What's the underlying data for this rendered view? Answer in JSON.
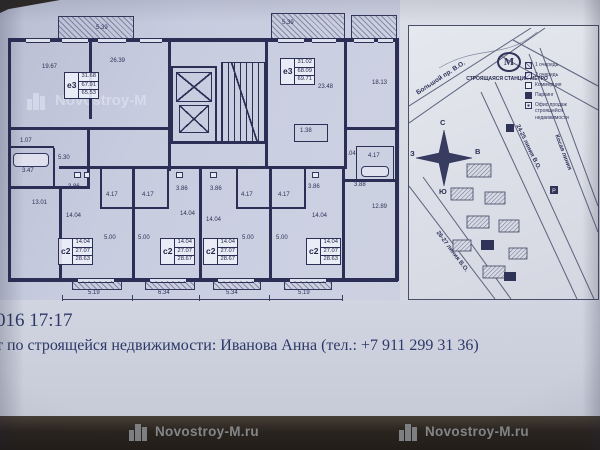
{
  "branding": {
    "watermark_full": "Novostroy-M.ru",
    "watermark_short": "Novostroy-M"
  },
  "footer": {
    "timestamp": "016 17:17",
    "contact_line": "т по строящейся недвижимости: Иванова Анна (тел.: +7 911 299 31 36)"
  },
  "floorplan": {
    "apartments": {
      "left": {
        "code": "е3",
        "areas": [
          "31.68",
          "67.91",
          "65.53"
        ]
      },
      "mid": {
        "code": "е3",
        "areas": [
          "31.02",
          "68.09",
          "69.71"
        ]
      }
    },
    "studios": [
      {
        "code": "с2",
        "areas": [
          "14.04",
          "27.07",
          "28.63"
        ]
      },
      {
        "code": "с2",
        "areas": [
          "14.04",
          "27.07",
          "28.67"
        ]
      },
      {
        "code": "с2",
        "areas": [
          "14.04",
          "27.07",
          "28.67"
        ]
      },
      {
        "code": "с2",
        "areas": [
          "14.04",
          "27.07",
          "28.63"
        ]
      }
    ],
    "dims": {
      "balcony_left": "5.39",
      "balcony_mid": "5.39",
      "room_tl": "19.67",
      "room_tl2": "26.39",
      "room_mid": "23.48",
      "room_tr": "18.13",
      "room_bl": "13.01",
      "hall_left": "5.30",
      "bath_left": "3.47",
      "niche_left": "1.07",
      "niche_mid": "1.38",
      "room_r1": "8.04",
      "bath_right": "4.17",
      "room_r2": "12.89",
      "hall_right": "3.88"
    },
    "hall_dims": [
      "3.86",
      "3.86",
      "3.86",
      "3.86"
    ],
    "bath_dims": [
      "4.17",
      "4.17",
      "4.17",
      "4.17"
    ],
    "studio_dims": [
      "14.04",
      "14.04",
      "14.04",
      "14.04"
    ],
    "inner_dims": [
      "5.00",
      "5.00",
      "5.00",
      "5.00"
    ],
    "bottom_dims": [
      "5.19",
      "6.34",
      "5.34",
      "5.19"
    ]
  },
  "sitemap": {
    "street_top": "Большой пр. В.О.",
    "street_right": "Косая линия",
    "street_24": "24-25 линия В.О.",
    "street_26": "26-27 линия В.О.",
    "metro": {
      "letter": "М",
      "label": "СТРОЯЩАЯСЯ СТАНЦИЯ МЕТРО"
    },
    "compass": {
      "n": "С",
      "e": "В",
      "s": "Ю",
      "w": "З"
    },
    "legend": [
      "1 очередь",
      "2 очередь",
      "Коммерция",
      "Паркинг",
      "Офис продаж строящейся недвижимости"
    ],
    "parking_letter": "Р"
  }
}
